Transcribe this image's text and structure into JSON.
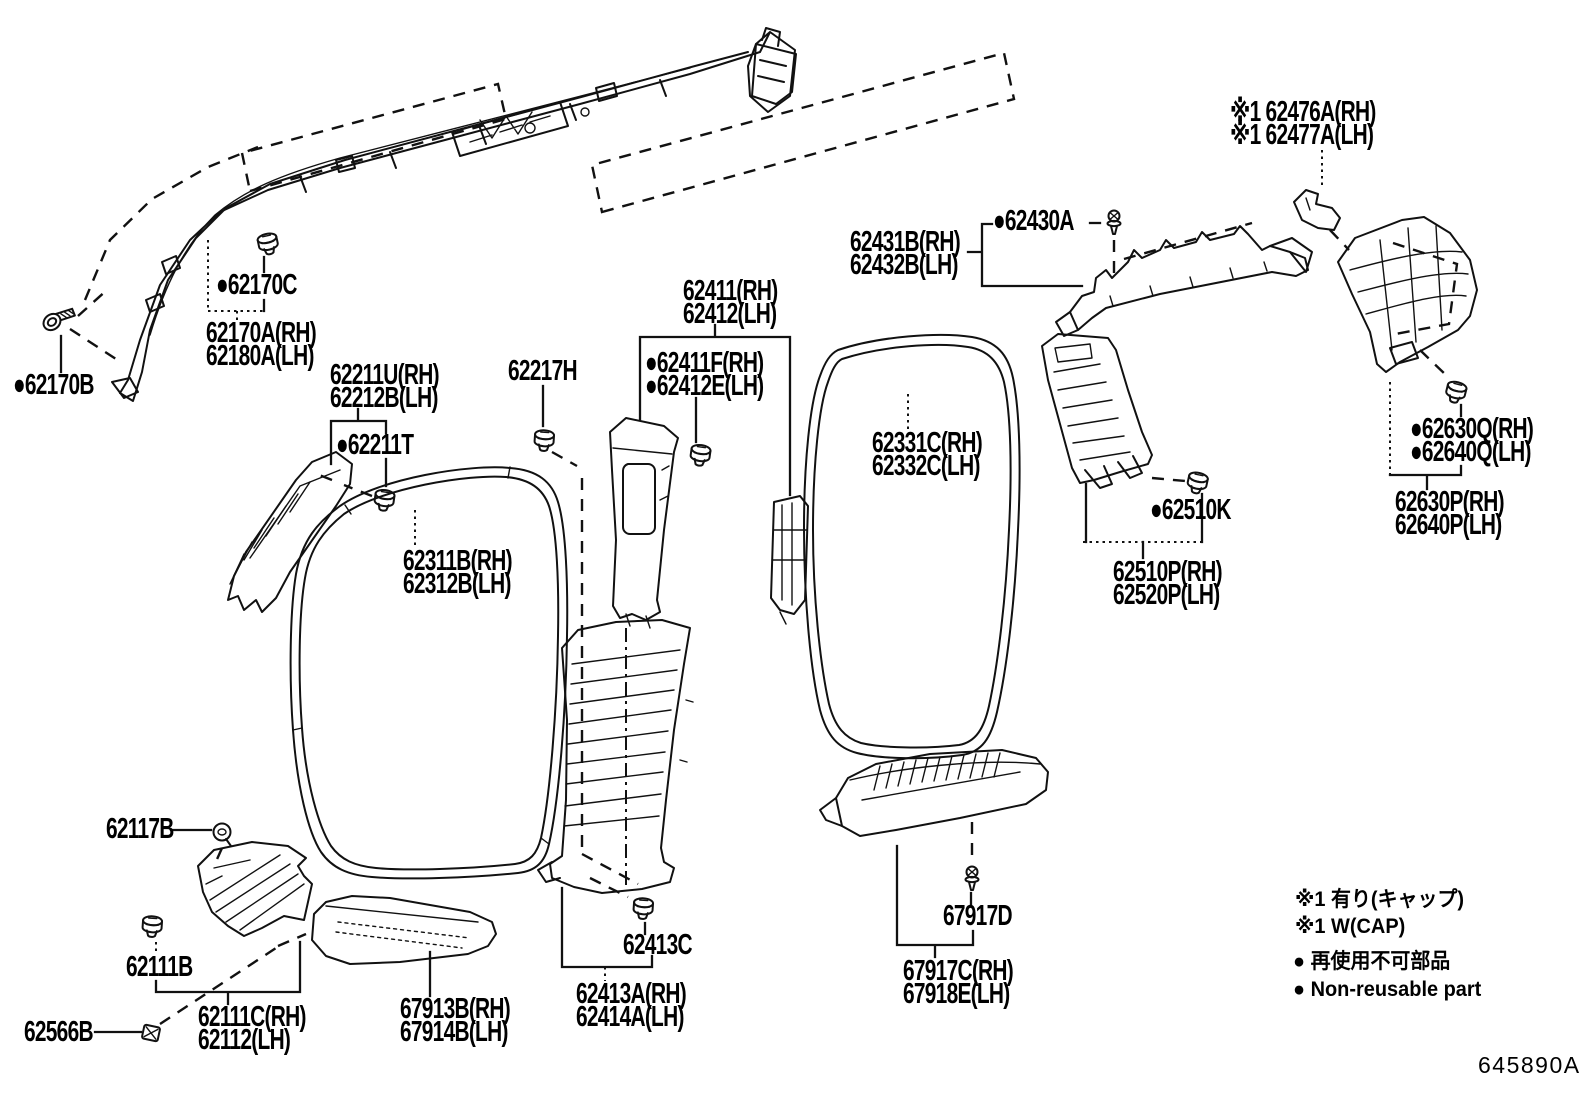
{
  "doc_number": "645890A",
  "legend": {
    "line1": "※1 有り(キャップ)",
    "line2": "※1 W(CAP)",
    "line3": "● 再使用不可部品",
    "line4": "● Non-reusable part"
  },
  "labels": {
    "p62170b": {
      "lines": [
        "●62170B"
      ]
    },
    "p62170c": {
      "lines": [
        "●62170C"
      ]
    },
    "p62170a": {
      "lines": [
        "62170A(RH)",
        "62180A(LH)"
      ]
    },
    "p62211u": {
      "lines": [
        "62211U(RH)",
        "62212B(LH)"
      ]
    },
    "p62211t": {
      "lines": [
        "●62211T"
      ]
    },
    "p62217h": {
      "lines": [
        "62217H"
      ]
    },
    "p62311b": {
      "lines": [
        "62311B(RH)",
        "62312B(LH)"
      ]
    },
    "p62411": {
      "lines": [
        "62411(RH)",
        "62412(LH)"
      ]
    },
    "p62411f": {
      "lines": [
        "●62411F(RH)",
        "●62412E(LH)"
      ]
    },
    "p62331c": {
      "lines": [
        "62331C(RH)",
        "62332C(LH)"
      ]
    },
    "p62431b": {
      "lines": [
        "62431B(RH)",
        "62432B(LH)"
      ]
    },
    "p62430a": {
      "lines": [
        "●62430A"
      ]
    },
    "p62476a": {
      "lines": [
        "※1 62476A(RH)",
        "※1 62477A(LH)"
      ]
    },
    "p62510k": {
      "lines": [
        "●62510K"
      ]
    },
    "p62510p": {
      "lines": [
        "62510P(RH)",
        "62520P(LH)"
      ]
    },
    "p62630q": {
      "lines": [
        "●62630Q(RH)",
        "●62640Q(LH)"
      ]
    },
    "p62630p": {
      "lines": [
        "62630P(RH)",
        "62640P(LH)"
      ]
    },
    "p62117b": {
      "lines": [
        "62117B"
      ]
    },
    "p62111b": {
      "lines": [
        "62111B"
      ]
    },
    "p62566b": {
      "lines": [
        "62566B"
      ]
    },
    "p62111c": {
      "lines": [
        "62111C(RH)",
        "62112(LH)"
      ]
    },
    "p67913b": {
      "lines": [
        "67913B(RH)",
        "67914B(LH)"
      ]
    },
    "p62413c": {
      "lines": [
        "62413C"
      ]
    },
    "p62413a": {
      "lines": [
        "62413A(RH)",
        "62414A(LH)"
      ]
    },
    "p67917d": {
      "lines": [
        "67917D"
      ]
    },
    "p67917c": {
      "lines": [
        "67917C(RH)",
        "67918E(LH)"
      ]
    }
  }
}
